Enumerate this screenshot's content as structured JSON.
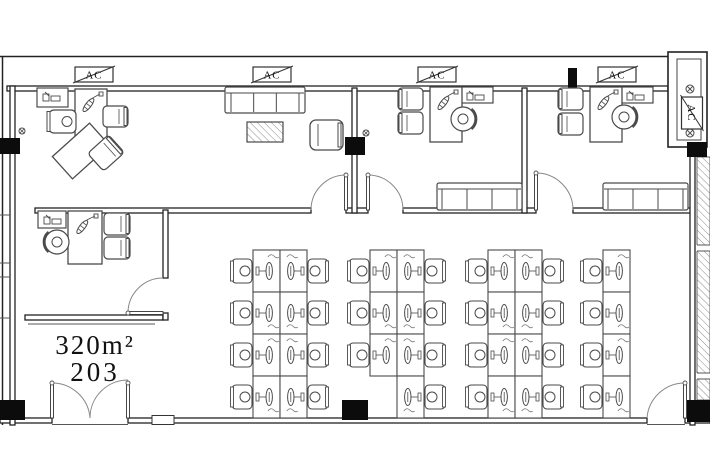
{
  "labels": {
    "ac": "AC",
    "area": "320m²",
    "room_number": "203"
  },
  "canvas": {
    "w": 710,
    "h": 472,
    "bg": "#ffffff",
    "wall_color": "#222222",
    "furniture_color": "#4a4a4a",
    "column_color": "#0c0c0c"
  },
  "ac_units": [
    {
      "x": 75,
      "y": 67,
      "w": 38,
      "h": 15
    },
    {
      "x": 253,
      "y": 67,
      "w": 38,
      "h": 15
    },
    {
      "x": 418,
      "y": 67,
      "w": 38,
      "h": 15
    },
    {
      "x": 598,
      "y": 67,
      "w": 38,
      "h": 15
    }
  ],
  "ac_vertical": {
    "cx": 692,
    "cy": 113,
    "w": 32,
    "h": 21
  },
  "walls": {
    "outer_lines": [
      [
        0,
        56.5,
        670,
        56.5
      ],
      [
        2.5,
        56,
        2.5,
        425
      ]
    ],
    "double_h": [
      {
        "x": 7,
        "y": 86,
        "len": 661
      },
      {
        "x": 35,
        "y": 208,
        "len": 276
      },
      {
        "x": 346,
        "y": 208,
        "len": 22
      },
      {
        "x": 403,
        "y": 208,
        "len": 133
      },
      {
        "x": 573,
        "y": 208,
        "len": 119
      },
      {
        "x": 25,
        "y": 315,
        "len": 138
      },
      {
        "x": 0,
        "y": 418,
        "len": 52
      },
      {
        "x": 128,
        "y": 418,
        "len": 519
      },
      {
        "x": 685,
        "y": 418,
        "len": 25
      }
    ],
    "double_v": [
      {
        "x": 10,
        "y": 86,
        "len": 339
      },
      {
        "x": 352,
        "y": 88,
        "len": 125
      },
      {
        "x": 522,
        "y": 88,
        "len": 125
      },
      {
        "x": 690,
        "y": 147,
        "len": 278
      },
      {
        "x": 163,
        "y": 210,
        "len": 68
      },
      {
        "x": 163,
        "y": 313,
        "len": 7
      }
    ],
    "thin_lines": [
      [
        28,
        324,
        155,
        324
      ],
      [
        0,
        215,
        10,
        215
      ],
      [
        0,
        263,
        10,
        263
      ],
      [
        0,
        277,
        10,
        277
      ],
      [
        0,
        318,
        10,
        318
      ],
      [
        52,
        424.5,
        128,
        424.5
      ],
      [
        647,
        424.5,
        685,
        424.5
      ]
    ]
  },
  "columns": [
    [
      0,
      138,
      20,
      16
    ],
    [
      345,
      137,
      20,
      18
    ],
    [
      687,
      142,
      20,
      15
    ],
    [
      568,
      68,
      9,
      20
    ],
    [
      0,
      400,
      25,
      20
    ],
    [
      342,
      400,
      26,
      20
    ],
    [
      687,
      400,
      23,
      22
    ]
  ],
  "shaft": {
    "outer": [
      668,
      52,
      39,
      95
    ],
    "inner": [
      677,
      59,
      24,
      81
    ],
    "fans": [
      [
        690,
        89
      ],
      [
        690,
        133
      ]
    ]
  },
  "hatch_strip": {
    "x": 697,
    "y": 157,
    "w": 13,
    "h": 243,
    "dividers": [
      245,
      373
    ]
  },
  "window_marker": [
    152,
    415.5,
    22,
    9
  ],
  "doors": [
    {
      "leaf": [
        346,
        175,
        346,
        210
      ],
      "arc": "M311,210 A35,35 0 0 1 346,175",
      "dot": [
        346,
        175
      ]
    },
    {
      "leaf": [
        368,
        175,
        368,
        210
      ],
      "arc": "M368,175 A35,35 0 0 1 403,210",
      "dot": [
        368,
        175
      ]
    },
    {
      "leaf": [
        536,
        173,
        536,
        210
      ],
      "arc": "M536,173 A37,37 0 0 1 573,210",
      "dot": [
        536,
        173
      ]
    },
    {
      "leaf": [
        128,
        313,
        163,
        313
      ],
      "arc": "M128,313 A35,35 0 0 1 163,278",
      "dot": [
        128,
        313
      ]
    },
    {
      "leaf": [
        52,
        383,
        52,
        418
      ],
      "arc": "M52,383 A38,38 0 0 1 90,418",
      "dot": [
        52,
        383
      ]
    },
    {
      "leaf": [
        128,
        383,
        128,
        418
      ],
      "arc": "M90,418 A38,38 0 0 1 128,380",
      "dot": [
        128,
        383
      ]
    },
    {
      "leaf": [
        685,
        383,
        685,
        418
      ],
      "arc": "M647,418 A38,38 0 0 1 685,383",
      "dot": [
        685,
        383
      ]
    }
  ],
  "sprinklers": [
    [
      22,
      131
    ],
    [
      366,
      133
    ]
  ],
  "furniture": {
    "sofa": {
      "x": 225,
      "y": 87,
      "w": 80,
      "h": 26
    },
    "benches": [
      {
        "x": 437,
        "y": 183,
        "w": 85,
        "h": 27
      },
      {
        "x": 603,
        "y": 183,
        "w": 85,
        "h": 27
      }
    ],
    "coffee_table": {
      "x": 247,
      "y": 122,
      "w": 36,
      "h": 20
    },
    "armchair": {
      "x": 310,
      "y": 120,
      "w": 33,
      "h": 30
    },
    "shelves": [
      {
        "x": 37,
        "y": 88,
        "w": 31,
        "h": 19
      },
      {
        "x": 461,
        "y": 87,
        "w": 32,
        "h": 16
      },
      {
        "x": 621,
        "y": 87,
        "w": 32,
        "h": 16
      },
      {
        "x": 38,
        "y": 211,
        "w": 28,
        "h": 17
      }
    ],
    "desks": [
      {
        "x": 75,
        "y": 89,
        "w": 32,
        "h": 51
      },
      {
        "x": 430,
        "y": 87,
        "w": 32,
        "h": 55
      },
      {
        "x": 590,
        "y": 87,
        "w": 32,
        "h": 55
      },
      {
        "x": 68,
        "y": 211,
        "w": 34,
        "h": 53
      }
    ],
    "desk_return": {
      "cx": 81,
      "cy": 151,
      "w": 50,
      "h": 30,
      "rot": -42
    },
    "exec_chair": {
      "x": 49,
      "y": 110,
      "w": 27,
      "h": 23
    },
    "guest_chairs": [
      {
        "x": 103,
        "y": 106,
        "w": 25,
        "h": 21,
        "back": "right"
      },
      {
        "cx": 106,
        "cy": 153,
        "w": 28,
        "h": 24,
        "back": "right",
        "rot": -42
      },
      {
        "x": 398,
        "y": 88,
        "w": 25,
        "h": 22,
        "back": "left"
      },
      {
        "x": 398,
        "y": 112,
        "w": 25,
        "h": 22,
        "back": "left"
      },
      {
        "x": 558,
        "y": 88,
        "w": 25,
        "h": 22,
        "back": "left"
      },
      {
        "x": 558,
        "y": 113,
        "w": 25,
        "h": 22,
        "back": "left"
      },
      {
        "x": 104,
        "y": 213,
        "w": 26,
        "h": 22,
        "back": "right"
      },
      {
        "x": 104,
        "y": 237,
        "w": 26,
        "h": 22,
        "back": "right"
      }
    ],
    "round_chairs": [
      {
        "cx": 463,
        "cy": 119,
        "back": "right"
      },
      {
        "cx": 624,
        "cy": 117,
        "back": "right"
      },
      {
        "cx": 57,
        "cy": 242,
        "back": "left"
      }
    ]
  },
  "clusters": [
    {
      "x": 253,
      "y": 250,
      "cols": 2,
      "rows": 4,
      "cell_w": 27,
      "cell_h": 42,
      "chairs": "both",
      "skip": []
    },
    {
      "x": 370,
      "y": 250,
      "cols": 2,
      "rows": 4,
      "cell_w": 27,
      "cell_h": 42,
      "chairs": "both",
      "skip": [
        [
          0,
          3
        ]
      ]
    },
    {
      "x": 488,
      "y": 250,
      "cols": 2,
      "rows": 4,
      "cell_w": 27,
      "cell_h": 42,
      "chairs": "both",
      "skip": []
    },
    {
      "x": 603,
      "y": 250,
      "cols": 1,
      "rows": 4,
      "cell_w": 27,
      "cell_h": 42,
      "chairs": "left",
      "skip": []
    }
  ]
}
